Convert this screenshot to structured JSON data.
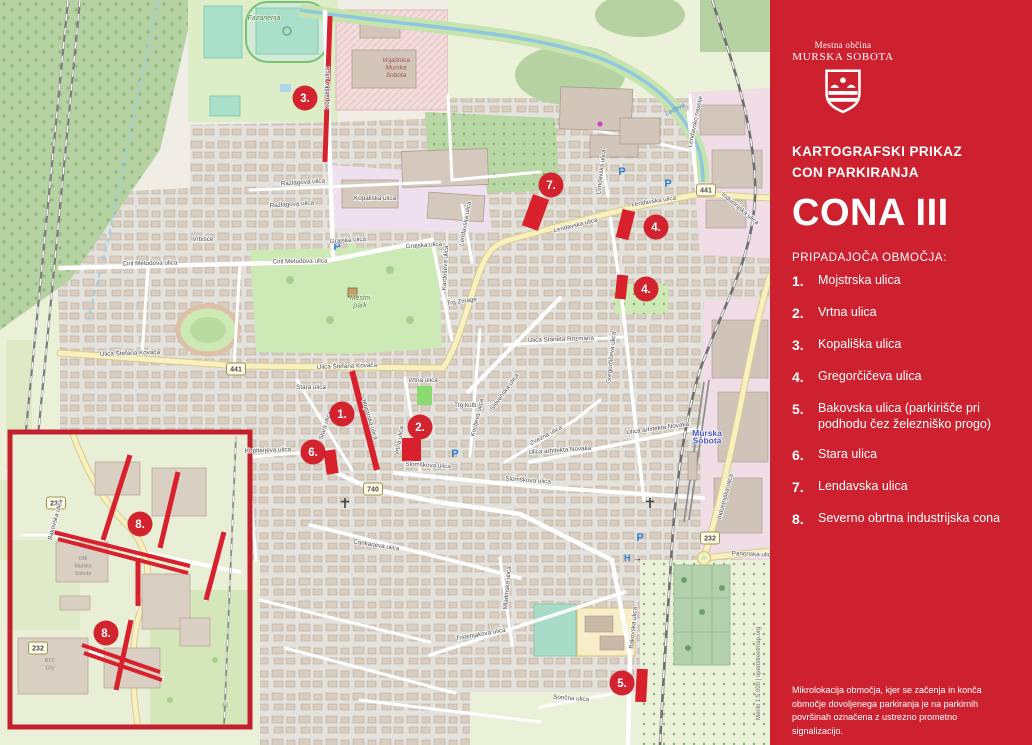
{
  "sidebar": {
    "logo_line1": "Mestna občina",
    "logo_line2": "MURSKA SOBOTA",
    "subtitle_line1": "KARTOGRAFSKI PRIKAZ",
    "subtitle_line2": "CON PARKIRANJA",
    "zone_title": "CONA III",
    "list_heading": "PRIPADAJOČA OBMOČJA:",
    "items": [
      {
        "num": "1.",
        "label": "Mojstrska ulica"
      },
      {
        "num": "2.",
        "label": "Vrtna ulica"
      },
      {
        "num": "3.",
        "label": "Kopališka ulica"
      },
      {
        "num": "4.",
        "label": "Gregorčičeva ulica"
      },
      {
        "num": "5.",
        "label": "Bakovska ulica (parkirišče pri podhodu čez železniško progo)"
      },
      {
        "num": "6.",
        "label": "Stara ulica"
      },
      {
        "num": "7.",
        "label": "Lendavska ulica"
      },
      {
        "num": "8.",
        "label": "Severno obrtna industrijska cona"
      }
    ],
    "footnote": "Mikrolokacija območja, kjer se začenja in konča območje dovoljenega parkiranja je na parkirnih površinah označena z ustrezno prometno signalizacijo.",
    "bg_color": "#ce2130"
  },
  "map": {
    "colors": {
      "marker_red": "#d2232f",
      "zone_red": "#d8212d"
    },
    "attribution": "Merilo 1:5.000 | openstreetmap.org",
    "markers": [
      {
        "t": "1.",
        "x": 342,
        "y": 414
      },
      {
        "t": "2.",
        "x": 420,
        "y": 427
      },
      {
        "t": "3.",
        "x": 305,
        "y": 98
      },
      {
        "t": "4.",
        "x": 656,
        "y": 227
      },
      {
        "t": "4.",
        "x": 646,
        "y": 289
      },
      {
        "t": "5.",
        "x": 622,
        "y": 683
      },
      {
        "t": "6.",
        "x": 313,
        "y": 452
      },
      {
        "t": "7.",
        "x": 551,
        "y": 185
      },
      {
        "t": "8.",
        "x": 140,
        "y": 524
      },
      {
        "t": "8.",
        "x": 106,
        "y": 633
      }
    ],
    "zone_marks": [
      {
        "type": "rect",
        "x": 325,
        "y": 16,
        "w": 5,
        "h": 146,
        "rot": 2
      },
      {
        "type": "rect",
        "x": 527,
        "y": 196,
        "w": 17,
        "h": 33,
        "rot": 20
      },
      {
        "type": "rect",
        "x": 619,
        "y": 210,
        "w": 13,
        "h": 29,
        "rot": 14
      },
      {
        "type": "rect",
        "x": 616,
        "y": 275,
        "w": 11,
        "h": 24,
        "rot": 6
      },
      {
        "type": "line",
        "x1": 352,
        "y1": 371,
        "x2": 377,
        "y2": 470,
        "w": 6
      },
      {
        "type": "rect",
        "x": 402,
        "y": 438,
        "w": 19,
        "h": 23,
        "rot": 0
      },
      {
        "type": "rect",
        "x": 325,
        "y": 450,
        "w": 12,
        "h": 24,
        "rot": -8
      },
      {
        "type": "rect",
        "x": 636,
        "y": 669,
        "w": 11,
        "h": 33,
        "rot": 3
      },
      {
        "type": "line",
        "x1": 130,
        "y1": 455,
        "x2": 103,
        "y2": 540,
        "w": 5
      },
      {
        "type": "line",
        "x1": 178,
        "y1": 472,
        "x2": 160,
        "y2": 548,
        "w": 5
      },
      {
        "type": "line",
        "x1": 53,
        "y1": 532,
        "x2": 190,
        "y2": 566,
        "w": 4
      },
      {
        "type": "line",
        "x1": 58,
        "y1": 539,
        "x2": 188,
        "y2": 573,
        "w": 4
      },
      {
        "type": "line",
        "x1": 138,
        "y1": 558,
        "x2": 138,
        "y2": 606,
        "w": 5
      },
      {
        "type": "line",
        "x1": 224,
        "y1": 532,
        "x2": 206,
        "y2": 600,
        "w": 5
      },
      {
        "type": "line",
        "x1": 82,
        "y1": 645,
        "x2": 160,
        "y2": 672,
        "w": 4
      },
      {
        "type": "line",
        "x1": 84,
        "y1": 653,
        "x2": 162,
        "y2": 680,
        "w": 4
      },
      {
        "type": "line",
        "x1": 131,
        "y1": 620,
        "x2": 116,
        "y2": 690,
        "w": 5
      }
    ],
    "road_badges": [
      {
        "t": "441",
        "x": 236,
        "y": 369
      },
      {
        "t": "441",
        "x": 706,
        "y": 190
      },
      {
        "t": "740",
        "x": 373,
        "y": 489
      },
      {
        "t": "232",
        "x": 710,
        "y": 538
      },
      {
        "t": "232",
        "x": 56,
        "y": 503
      },
      {
        "t": "232",
        "x": 38,
        "y": 648
      }
    ],
    "parking_icons": [
      {
        "x": 337,
        "y": 250
      },
      {
        "x": 622,
        "y": 175
      },
      {
        "x": 668,
        "y": 187
      },
      {
        "x": 455,
        "y": 457
      },
      {
        "x": 640,
        "y": 541
      }
    ],
    "hospital_icon": {
      "h": "H",
      "arrow": "→",
      "x": 633,
      "y": 561
    },
    "place_labels": [
      {
        "cls": "park",
        "x": 264,
        "y": 20,
        "lines": [
          "Fazanerija"
        ]
      },
      {
        "cls": "military",
        "x": 396,
        "y": 62,
        "lines": [
          "Vojašnica",
          "Murska",
          "Sobota"
        ]
      },
      {
        "cls": "park",
        "x": 360,
        "y": 300,
        "lines": [
          "Mestni",
          "park"
        ]
      },
      {
        "cls": "city",
        "x": 707,
        "y": 436,
        "lines": [
          "Murska",
          "Sobota"
        ]
      },
      {
        "cls": "water",
        "x": 676,
        "y": 111,
        "lines": [
          "Ledava"
        ],
        "r": -28
      },
      {
        "cls": "poi",
        "x": 83,
        "y": 560,
        "lines": [
          "OBI",
          "Murska",
          "Sobota"
        ]
      },
      {
        "cls": "poi",
        "x": 50,
        "y": 662,
        "lines": [
          "BTC",
          "City"
        ]
      }
    ],
    "street_labels": [
      {
        "t": "Kopališka ulica",
        "x": 329,
        "y": 88,
        "r": -90
      },
      {
        "t": "Kopališka ulica",
        "x": 375,
        "y": 200,
        "r": 0
      },
      {
        "t": "Razlagova ulica",
        "x": 303,
        "y": 184,
        "r": -4
      },
      {
        "t": "Razlagova ulica",
        "x": 292,
        "y": 206,
        "r": -4
      },
      {
        "t": "Vrbišče",
        "x": 203,
        "y": 241,
        "r": 0
      },
      {
        "t": "Ciril Metodova ulica",
        "x": 150,
        "y": 265,
        "r": -1
      },
      {
        "t": "Ciril Metodova ulica",
        "x": 300,
        "y": 263,
        "r": -1
      },
      {
        "t": "Grajska ulica",
        "x": 348,
        "y": 242,
        "r": -4
      },
      {
        "t": "Grajska ulica",
        "x": 424,
        "y": 247,
        "r": -4
      },
      {
        "t": "Ulica Štefana Kovača",
        "x": 130,
        "y": 355,
        "r": -2
      },
      {
        "t": "Ulica Štefana Kovača",
        "x": 347,
        "y": 368,
        "r": -2
      },
      {
        "t": "Lendavska ulica",
        "x": 576,
        "y": 227,
        "r": -14
      },
      {
        "t": "Lendavska ulica",
        "x": 654,
        "y": 203,
        "r": -9
      },
      {
        "t": "Lendavska ulica",
        "x": 603,
        "y": 172,
        "r": -83
      },
      {
        "t": "Lendavska ulica",
        "x": 467,
        "y": 224,
        "r": -80
      },
      {
        "t": "Lendavsko naselje",
        "x": 697,
        "y": 122,
        "r": -78
      },
      {
        "t": "Industrijska ulica",
        "x": 739,
        "y": 210,
        "r": 40
      },
      {
        "t": "Industrijska ulica",
        "x": 727,
        "y": 497,
        "r": -75
      },
      {
        "t": "Stara ulica",
        "x": 311,
        "y": 389,
        "r": 0
      },
      {
        "t": "Stara ulica",
        "x": 327,
        "y": 426,
        "r": -72
      },
      {
        "t": "Vrtna ulica",
        "x": 423,
        "y": 382,
        "r": 0
      },
      {
        "t": "Vrtna ulica",
        "x": 401,
        "y": 441,
        "r": -80
      },
      {
        "t": "Mojstrska ulica",
        "x": 368,
        "y": 420,
        "r": 73
      },
      {
        "t": "Kopitarjeva ulica",
        "x": 268,
        "y": 452,
        "r": -2
      },
      {
        "t": "Slomškova ulica",
        "x": 428,
        "y": 467,
        "r": 3
      },
      {
        "t": "Slomškova ulica",
        "x": 528,
        "y": 482,
        "r": 4
      },
      {
        "t": "Trg kulture",
        "x": 469,
        "y": 407,
        "r": 0
      },
      {
        "t": "Trg Zmage",
        "x": 462,
        "y": 303,
        "r": -8
      },
      {
        "t": "Gregorčičeva ulica",
        "x": 613,
        "y": 358,
        "r": -84
      },
      {
        "t": "Ulica Staneta Rozmana",
        "x": 561,
        "y": 341,
        "r": -2
      },
      {
        "t": "Ulica arhitekta Novaka",
        "x": 560,
        "y": 452,
        "r": -4
      },
      {
        "t": "Ulica arhitekta Novaka",
        "x": 658,
        "y": 430,
        "r": -8
      },
      {
        "t": "Slovenska ulica",
        "x": 506,
        "y": 393,
        "r": -54
      },
      {
        "t": "Kocljeva ulica",
        "x": 479,
        "y": 418,
        "r": -76
      },
      {
        "t": "Zvezna ulica",
        "x": 547,
        "y": 437,
        "r": -28
      },
      {
        "t": "Kardoševa ulica",
        "x": 447,
        "y": 268,
        "r": -87
      },
      {
        "t": "Cankarjeva ulica",
        "x": 376,
        "y": 547,
        "r": 9
      },
      {
        "t": "Trstenjakova ulica",
        "x": 481,
        "y": 636,
        "r": -10
      },
      {
        "t": "Mladinska ulica",
        "x": 509,
        "y": 588,
        "r": -85
      },
      {
        "t": "Bakovska ulica",
        "x": 635,
        "y": 628,
        "r": -85
      },
      {
        "t": "Sončna ulica",
        "x": 571,
        "y": 700,
        "r": 4
      },
      {
        "t": "Panonska ulica",
        "x": 753,
        "y": 556,
        "r": 2
      },
      {
        "t": "Bakovska ulica",
        "x": 57,
        "y": 520,
        "r": -75
      }
    ]
  }
}
